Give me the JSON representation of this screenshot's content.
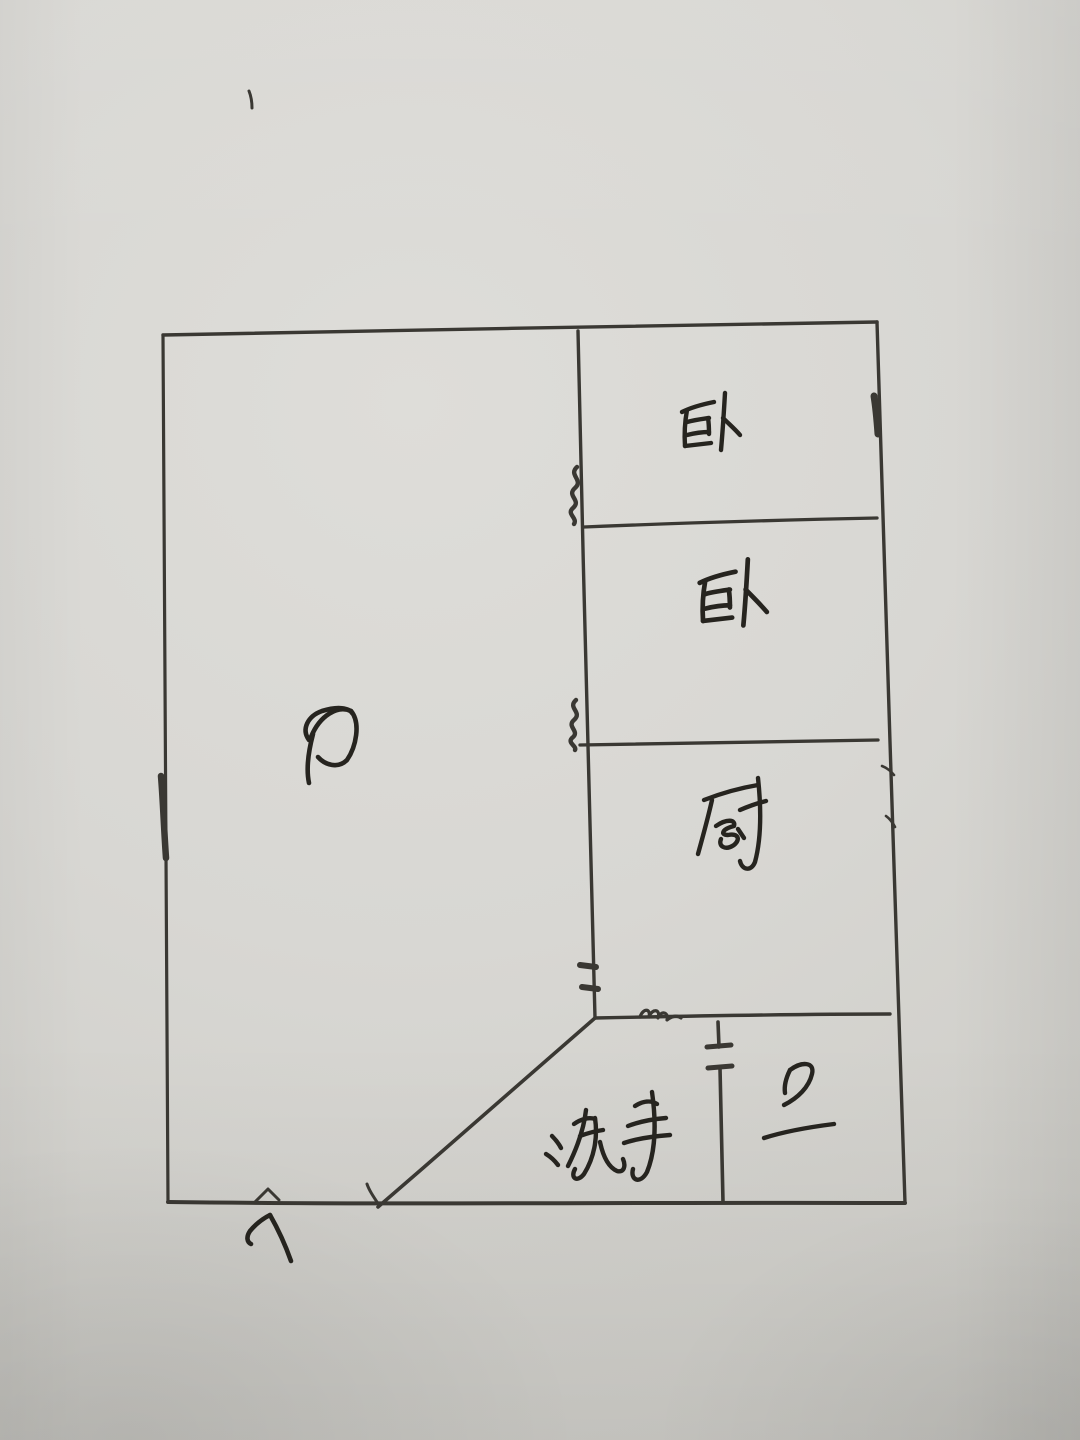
{
  "document": {
    "kind": "hand-drawn apartment floor plan sketch"
  },
  "colors": {
    "paper": "#d6d5d1",
    "wall_ink": "#3a3833",
    "label_ink": "#26241f"
  },
  "rooms": [
    {
      "id": "living-room",
      "label": "厅"
    },
    {
      "id": "bedroom-top",
      "label": "卧"
    },
    {
      "id": "bedroom-middle",
      "label": "卧"
    },
    {
      "id": "kitchen",
      "label": "厨"
    },
    {
      "id": "washroom",
      "label": "洗手"
    },
    {
      "id": "bathroom",
      "label": "卫"
    }
  ],
  "entrance": {
    "arrow_icon": "up-arrow"
  }
}
